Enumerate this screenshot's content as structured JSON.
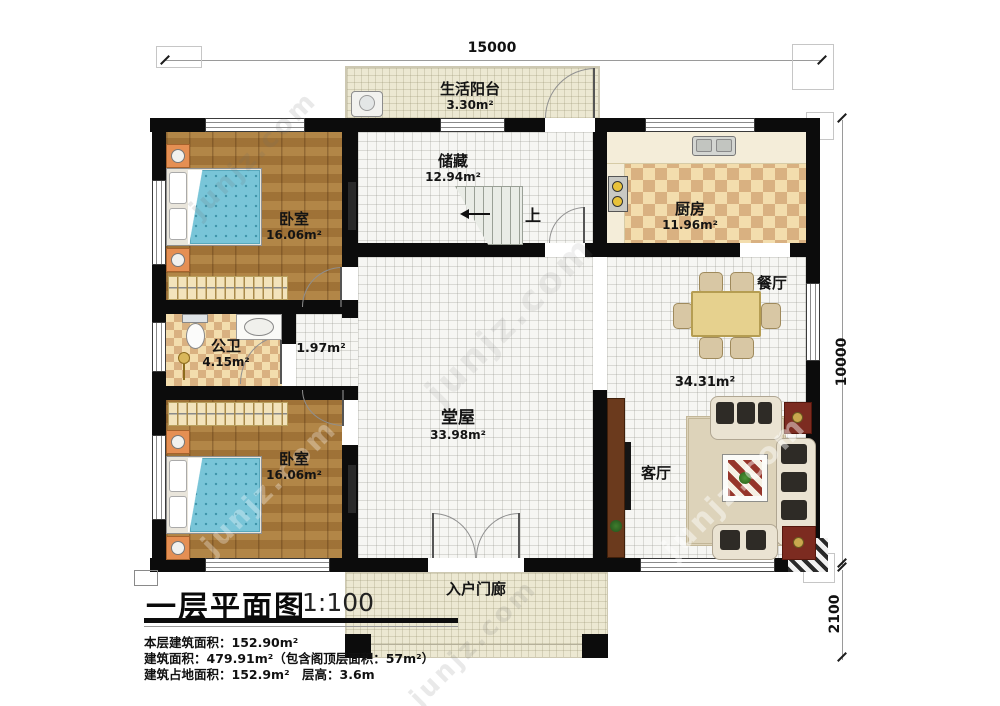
{
  "dimensions": {
    "top": "15000",
    "right": "10000",
    "bottom_right": "2100"
  },
  "rooms": {
    "balcony": {
      "name": "生活阳台",
      "area": "3.30m²"
    },
    "storage": {
      "name": "储藏",
      "area": "12.94m²"
    },
    "kitchen": {
      "name": "厨房",
      "area": "11.96m²"
    },
    "bedroom_top": {
      "name": "卧室",
      "area": "16.06m²"
    },
    "bathroom": {
      "name": "公卫",
      "area": "4.15m²"
    },
    "hallway": {
      "area": "1.97m²"
    },
    "bedroom_bottom": {
      "name": "卧室",
      "area": "16.06m²"
    },
    "hall": {
      "name": "堂屋",
      "area": "33.98m²"
    },
    "dining": {
      "name": "餐厅"
    },
    "dining_living": {
      "area": "34.31m²"
    },
    "living": {
      "name": "客厅"
    },
    "porch": {
      "name": "入户门廊"
    }
  },
  "stairs": {
    "up_label": "上"
  },
  "title_block": {
    "title": "一层平面图",
    "scale": "1:100",
    "line1": "本层建筑面积：152.90m²",
    "line2": "建筑面积：479.91m²（包含阁顶层面积：57m²）",
    "line3": "建筑占地面积：152.9m²　层高：3.6m"
  },
  "watermark": {
    "site": "junjz.com"
  },
  "colors": {
    "wall": "#0c0c0c",
    "wood_floor": "#a97b3c",
    "checker_tile": "#d9b181",
    "cream_floor": "#ece8d2",
    "accent_red": "#7c2b20"
  }
}
